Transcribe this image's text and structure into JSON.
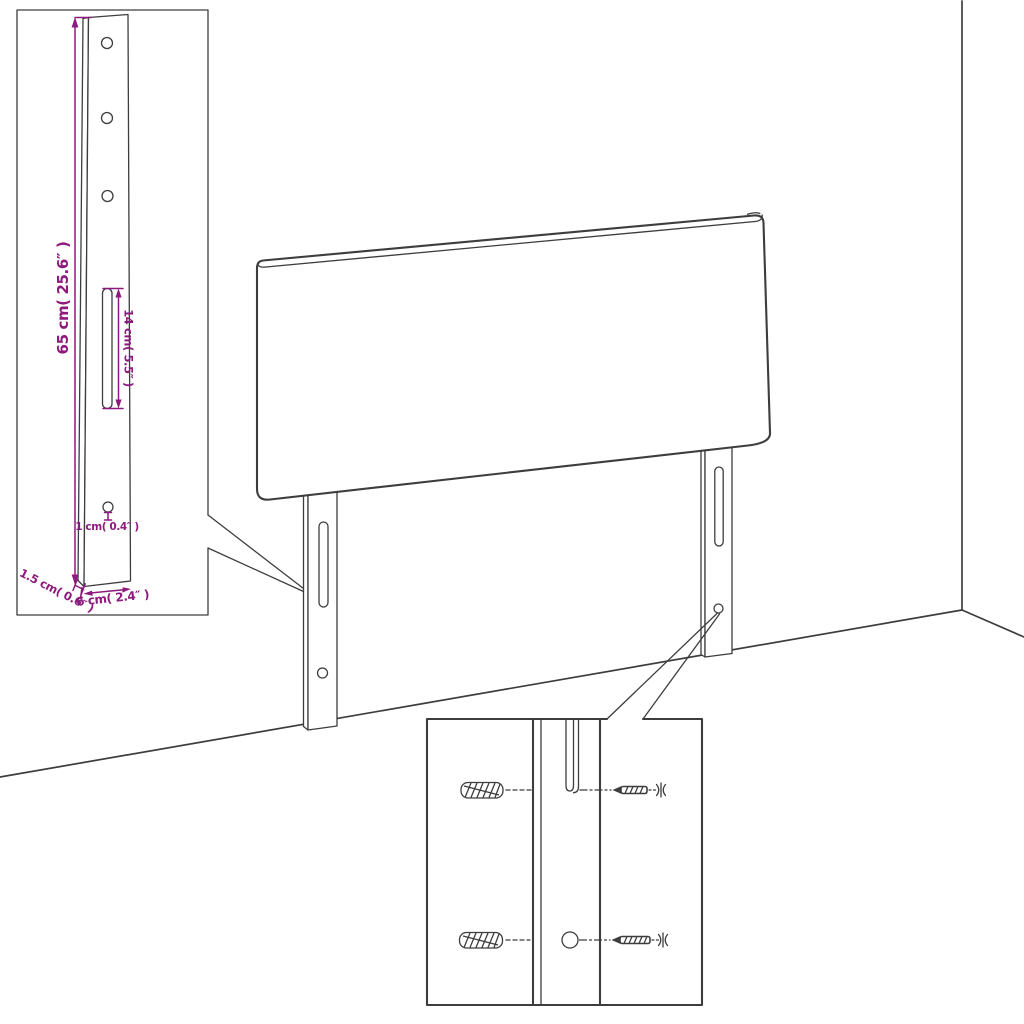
{
  "colors": {
    "line": "#3d3d3d",
    "dimension": "#8d1a7d",
    "background": "#ffffff"
  },
  "dims": {
    "height": {
      "label": "65 cm( 25.6″ )"
    },
    "slot": {
      "label": "14 cm( 5.5″ )"
    },
    "hole": {
      "label": "1 cm( 0.4″ )"
    },
    "depth": {
      "label": "1.5 cm( 0.6″ )"
    },
    "width": {
      "label": "6 cm( 2.4″ )"
    }
  },
  "icons": {
    "wall_anchor": "wall-anchor",
    "screw": "wood-screw"
  }
}
